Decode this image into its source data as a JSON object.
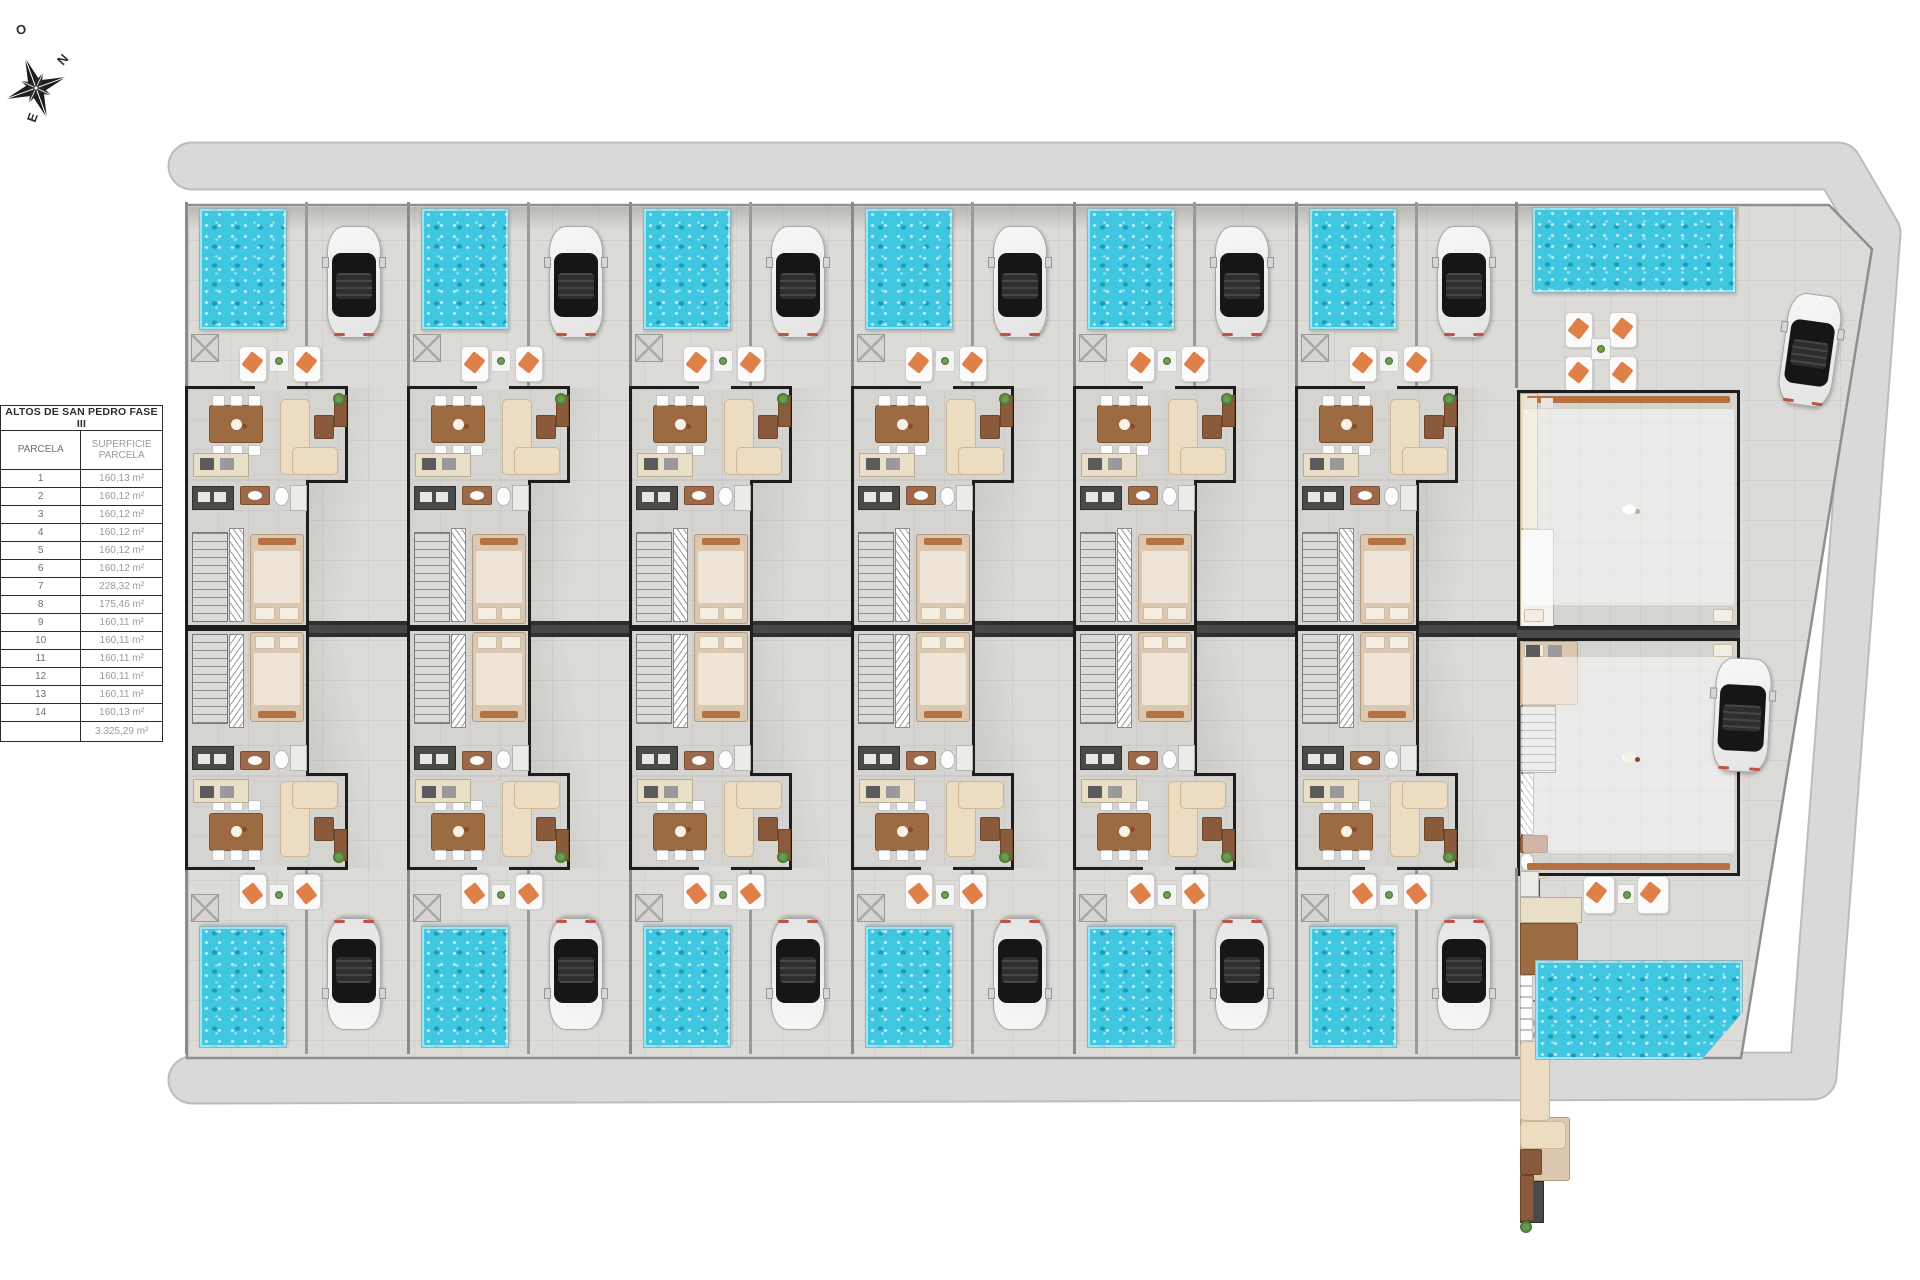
{
  "compass": {
    "top": "O",
    "right": "N",
    "bottom": "E"
  },
  "table": {
    "title": "ALTOS DE SAN PEDRO FASE III",
    "col_parcel": "PARCELA",
    "col_area": "SUPERFICIE PARCELA",
    "rows": [
      {
        "parcel": "1",
        "area": "160,13 m²"
      },
      {
        "parcel": "2",
        "area": "160,12 m²"
      },
      {
        "parcel": "3",
        "area": "160,12 m²"
      },
      {
        "parcel": "4",
        "area": "160,12 m²"
      },
      {
        "parcel": "5",
        "area": "160,12 m²"
      },
      {
        "parcel": "6",
        "area": "160,12 m²"
      },
      {
        "parcel": "7",
        "area": "228,32 m²"
      },
      {
        "parcel": "8",
        "area": "175,46 m²"
      },
      {
        "parcel": "9",
        "area": "160,11 m²"
      },
      {
        "parcel": "10",
        "area": "160,11 m²"
      },
      {
        "parcel": "11",
        "area": "160,11 m²"
      },
      {
        "parcel": "12",
        "area": "160,11 m²"
      },
      {
        "parcel": "13",
        "area": "160,11 m²"
      },
      {
        "parcel": "14",
        "area": "160,13 m²"
      }
    ],
    "total_area": "3.325,29 m²"
  },
  "plan": {
    "villa_columns": 6,
    "colors": {
      "road": "#d9d9d9",
      "pavement": "#dcdbd7",
      "pool_water": "#3fc6e0",
      "party_wall": "#2c2c2c",
      "towel_orange": "#df8049",
      "wood": "#9c6b42"
    }
  }
}
